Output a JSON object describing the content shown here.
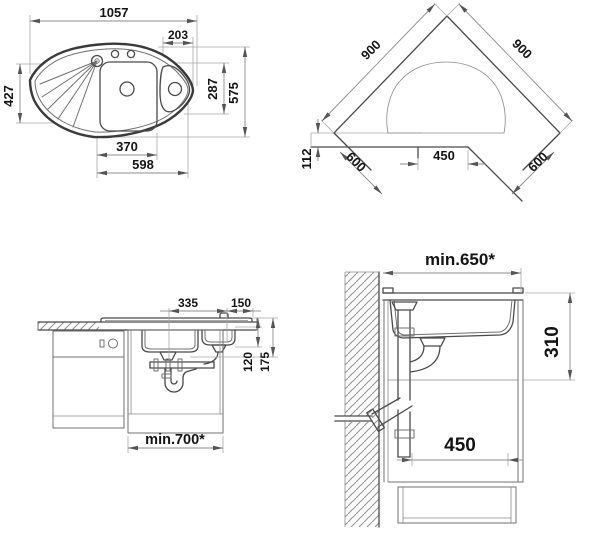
{
  "document": {
    "type": "sink installation drawing",
    "background": "#ffffff"
  },
  "colors": {
    "line_primary": "#3a3a3a",
    "line_secondary": "#707070",
    "dimension_line": "#8c8c8c",
    "text": "#141414"
  },
  "views": {
    "sink_plan": {
      "title": "sink top view",
      "dims": {
        "overall_width": "1057",
        "right_bowl_inset": "203",
        "left_depth": "427",
        "overall_depth": "575",
        "right_bowl_depth": "287",
        "main_bowl_width": "370",
        "front_width": "598"
      }
    },
    "corner_layout": {
      "title": "corner countertop layout",
      "dims": {
        "left_wall_run": "900",
        "right_wall_run": "900",
        "left_counter_depth": "600",
        "right_counter_depth": "600",
        "cabinet_opening": "450",
        "front_offset": "112"
      }
    },
    "front_section": {
      "title": "front section with plumbing",
      "dims": {
        "drain_offset": "335",
        "right_offset": "150",
        "trap_level_1": "120",
        "trap_level_2": "175",
        "cabinet_width_min": "min.700*"
      }
    },
    "side_section": {
      "title": "side section at wall",
      "dims": {
        "counter_depth_min": "min.650*",
        "rim_to_outlet": "310",
        "outlet_distance": "450"
      }
    }
  }
}
